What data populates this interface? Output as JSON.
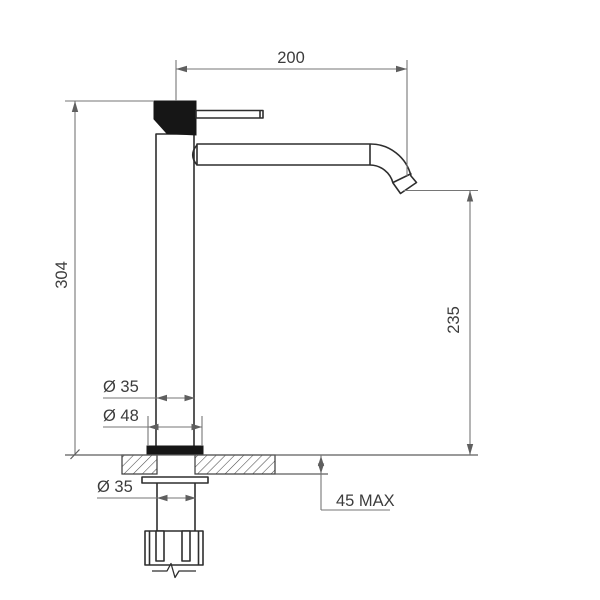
{
  "drawing": {
    "description": "faucet technical drawing",
    "dimensions": {
      "spout_reach": "200",
      "overall_height": "304",
      "spout_outlet_height": "235",
      "body_diameter": "Ø 35",
      "base_diameter": "Ø 48",
      "shank_diameter": "Ø 35",
      "max_deck_thickness": "45 MAX"
    },
    "colors": {
      "background": "#ffffff",
      "outline": "#2e2e2e",
      "dimension_lines": "#767676",
      "filled_parts": "#161616"
    }
  }
}
